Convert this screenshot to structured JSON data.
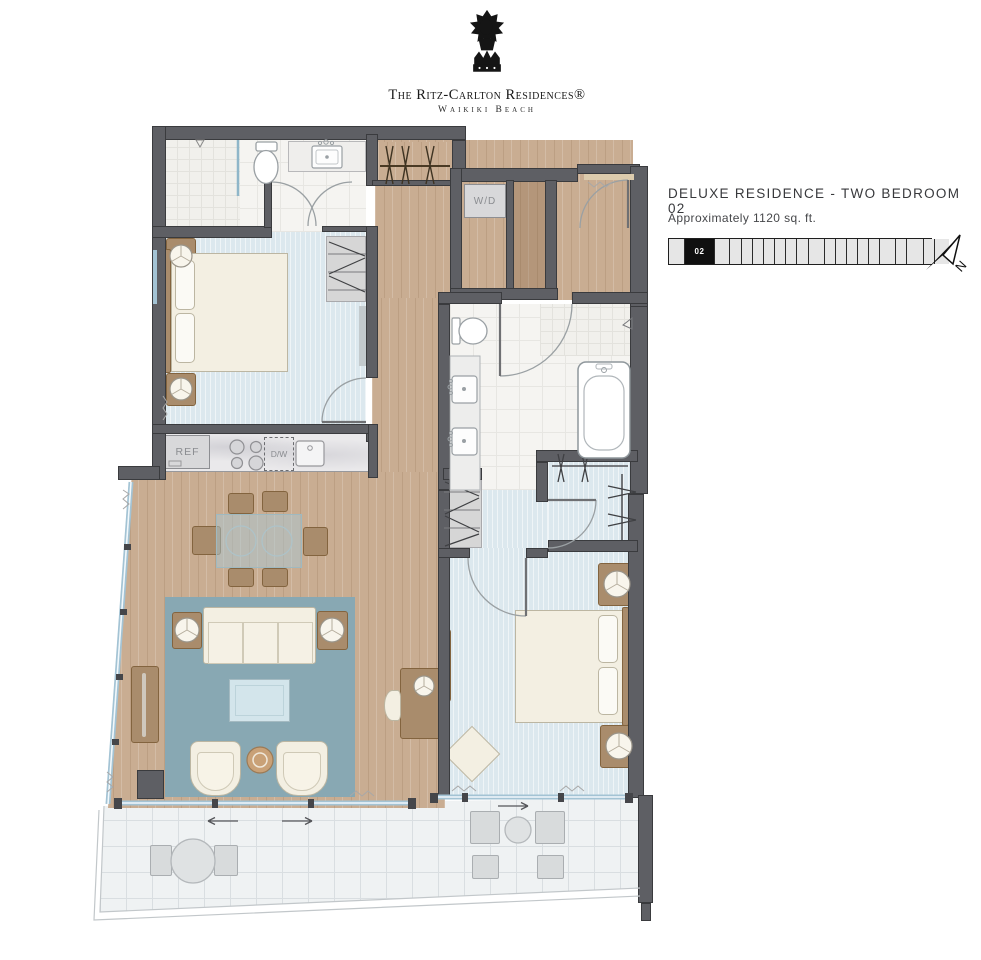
{
  "brand": {
    "name_line": "The Ritz-Carlton Residences®",
    "location_line": "Waikiki Beach"
  },
  "unit": {
    "title": "DELUXE RESIDENCE - TWO BEDROOM 02",
    "area": "Approximately 1120 sq. ft."
  },
  "keyplan": {
    "active_label": "02",
    "cells": [
      {
        "w": 15
      },
      {
        "w": 29,
        "active": true
      },
      {
        "w": 14
      },
      {
        "w": 11
      },
      {
        "w": 10
      },
      {
        "w": 10
      },
      {
        "w": 10
      },
      {
        "w": 10
      },
      {
        "w": 10
      },
      {
        "w": 11
      },
      {
        "w": 15
      },
      {
        "w": 10
      },
      {
        "w": 10
      },
      {
        "w": 10
      },
      {
        "w": 10
      },
      {
        "w": 10
      },
      {
        "w": 15
      },
      {
        "w": 10
      },
      {
        "w": 16
      },
      {
        "w": 10
      },
      {
        "w": 14
      }
    ]
  },
  "compass": {
    "north_label": "N"
  },
  "plan_labels": {
    "washer_dryer": "W/D",
    "refrigerator": "REF",
    "dishwasher": "D/W"
  },
  "colors": {
    "wall": "#5e5f64",
    "wood_floor": "#c9ad92",
    "carpet": "#dce8ee",
    "rug": "#88a8b3",
    "tile": "#f5f4f1",
    "terrace": "#eff2f3",
    "accent_black": "#1d1d1f"
  }
}
